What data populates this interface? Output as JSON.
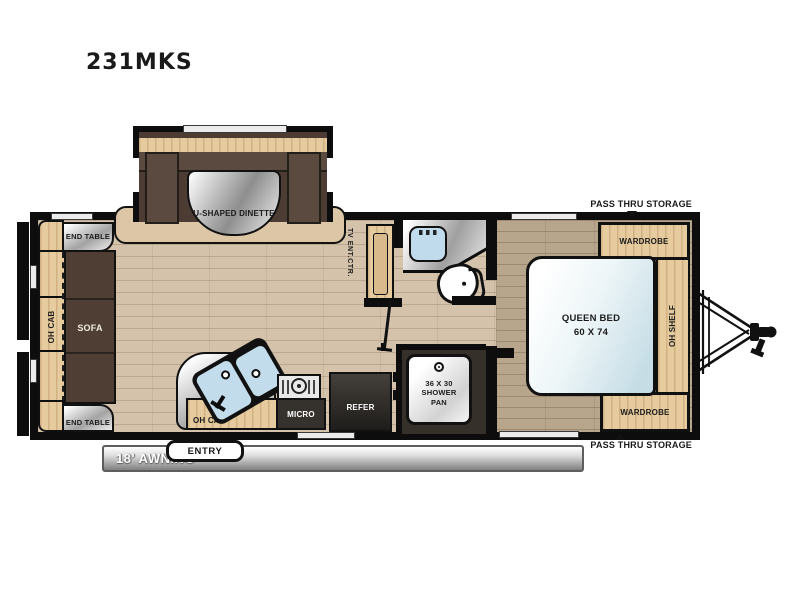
{
  "title": "231MKS",
  "labels": {
    "dinette": "U-SHAPED DINETTE",
    "end_table_top": "END TABLE",
    "end_table_bottom": "END TABLE",
    "oh_cab_left": "OH CAB",
    "sofa": "SOFA",
    "tv_ent_ctr": "TV ENT.CTR.",
    "oh_cab_kitchen": "OH CAB",
    "micro": "MICRO",
    "refer": "REFER",
    "shower": "36 X 30\nSHOWER\nPAN",
    "queen_bed": "QUEEN BED\n60 X 74",
    "wardrobe_top": "WARDROBE",
    "wardrobe_bottom": "WARDROBE",
    "oh_shelf": "OH SHELF",
    "pass_thru_top": "PASS THRU STORAGE",
    "pass_thru_bottom": "PASS THRU STORAGE",
    "entry": "ENTRY",
    "awning": "18' AWNING"
  },
  "colors": {
    "wall": "#0d0d0d",
    "floor_main": "#d4c2ab",
    "floor_bedroom": "#b7a58c",
    "cabinet_wood": "#e6cb9f",
    "sofa_brown": "#4e3e33",
    "appliance_dark": "#35312d",
    "fixture_blue": "#c0dbeb",
    "counter_silver": "#c9c9c9",
    "awning_gray": "#8a8a8a"
  }
}
